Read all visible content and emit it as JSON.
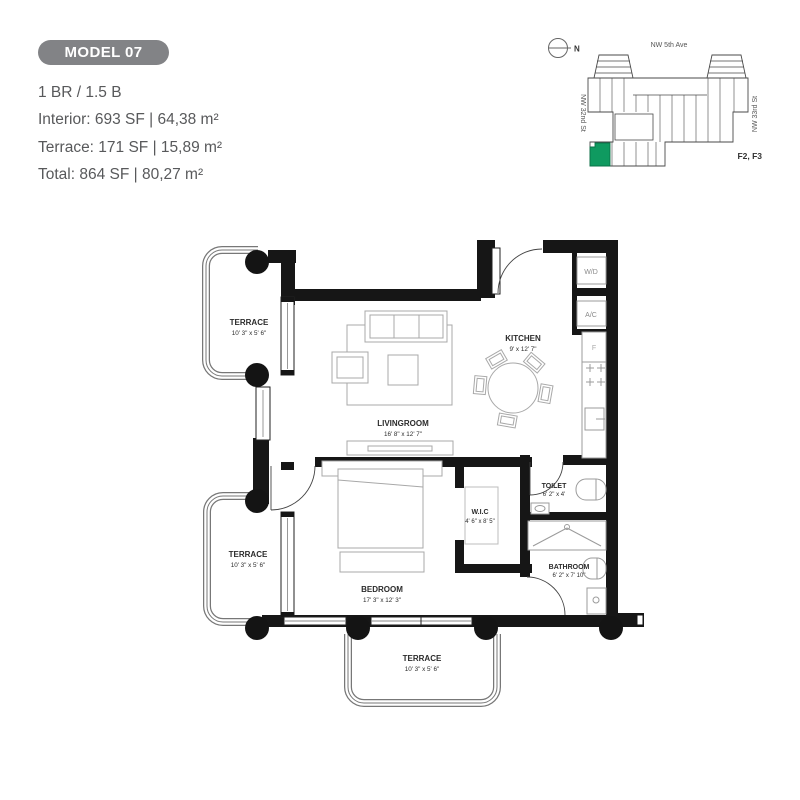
{
  "header": {
    "badge": "MODEL 07",
    "config": "1 BR / 1.5 B",
    "interior": "Interior: 693 SF | 64,38 m²",
    "terrace": "Terrace: 171 SF | 15,89 m²",
    "total": "Total: 864 SF | 80,27 m²"
  },
  "site_plan": {
    "north": "N",
    "street_top": "NW 5th Ave",
    "street_left": "NW 32nd St",
    "street_right": "NW 33rd St",
    "floors": "F2, F3",
    "unit_color": "#0f9a60"
  },
  "floor_plan": {
    "terrace_top": {
      "name": "TERRACE",
      "dims": "10' 3\" x 5' 6\""
    },
    "livingroom": {
      "name": "LIVINGROOM",
      "dims": "16' 8\" x 12' 7\""
    },
    "kitchen": {
      "name": "KITCHEN",
      "dims": "9' x 12' 7\""
    },
    "terrace_left": {
      "name": "TERRACE",
      "dims": "10' 3\" x 5' 6\""
    },
    "bedroom": {
      "name": "BEDROOM",
      "dims": "17' 3\" x 12' 3\""
    },
    "wic": {
      "name": "W.I.C",
      "dims": "4' 6\" x 8' 5\""
    },
    "toilet": {
      "name": "TOILET",
      "dims": "6' 2\" x 4'"
    },
    "bathroom": {
      "name": "BATHROOM",
      "dims": "6' 2\" x 7' 10\""
    },
    "terrace_bottom": {
      "name": "TERRACE",
      "dims": "10' 3\" x 5' 6\""
    },
    "fixtures": {
      "wd": "W/D",
      "ac": "A/C",
      "fridge": "F"
    }
  }
}
